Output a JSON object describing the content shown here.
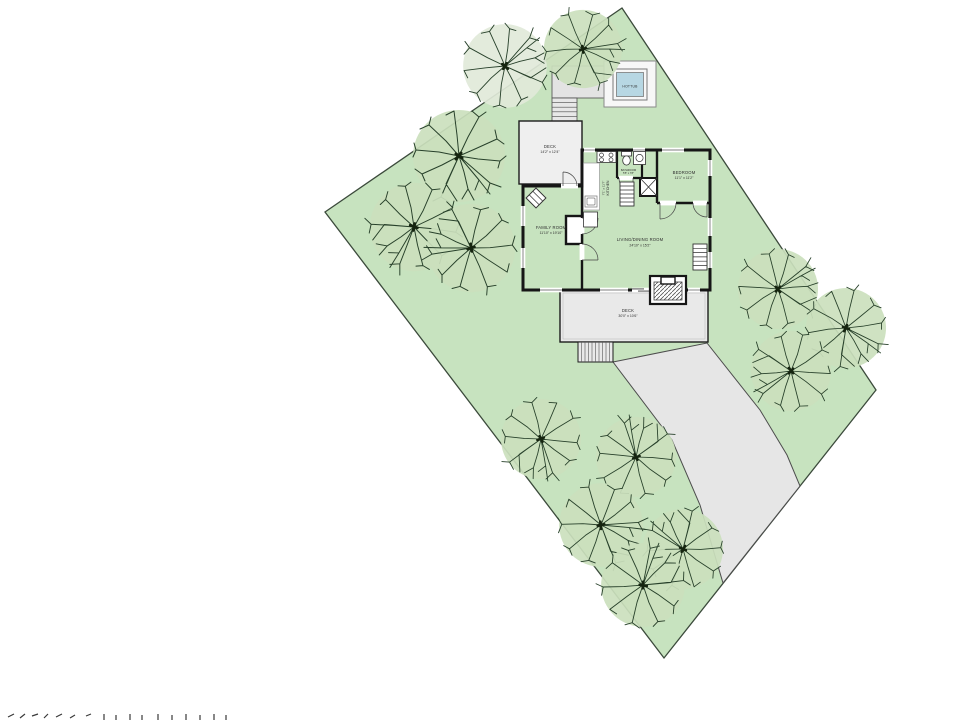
{
  "plan": {
    "rooms": {
      "deck_upper": {
        "name": "DECK",
        "dims": "14'2\" x 12'4\""
      },
      "family_room": {
        "name": "FAMILY ROOM",
        "dims": "11'10\" x 19'10\""
      },
      "living_dining": {
        "name": "LIVING/DINING ROOM",
        "dims": "24'10\" x 15'2\""
      },
      "kitchen": {
        "name": "KITCHEN",
        "dims": "7'1\" x 11'7\""
      },
      "bathroom": {
        "name": "BATHROOM",
        "dims": "5'5\" x 7'8\""
      },
      "bedroom": {
        "name": "BEDROOM",
        "dims": "11'1\" x 11'2\""
      },
      "deck_lower": {
        "name": "DECK",
        "dims": "30'0\" x 10'6\""
      },
      "hottub": {
        "name": "HOTTUB"
      }
    },
    "colors": {
      "lot_green": "#c7e3bf",
      "lot_edge": "#3b4a3b",
      "hardscape": "#e6e6e6",
      "deck_gray": "#ebebeb",
      "hottub_water": "#b7d7e3",
      "wall": "#161616"
    }
  }
}
